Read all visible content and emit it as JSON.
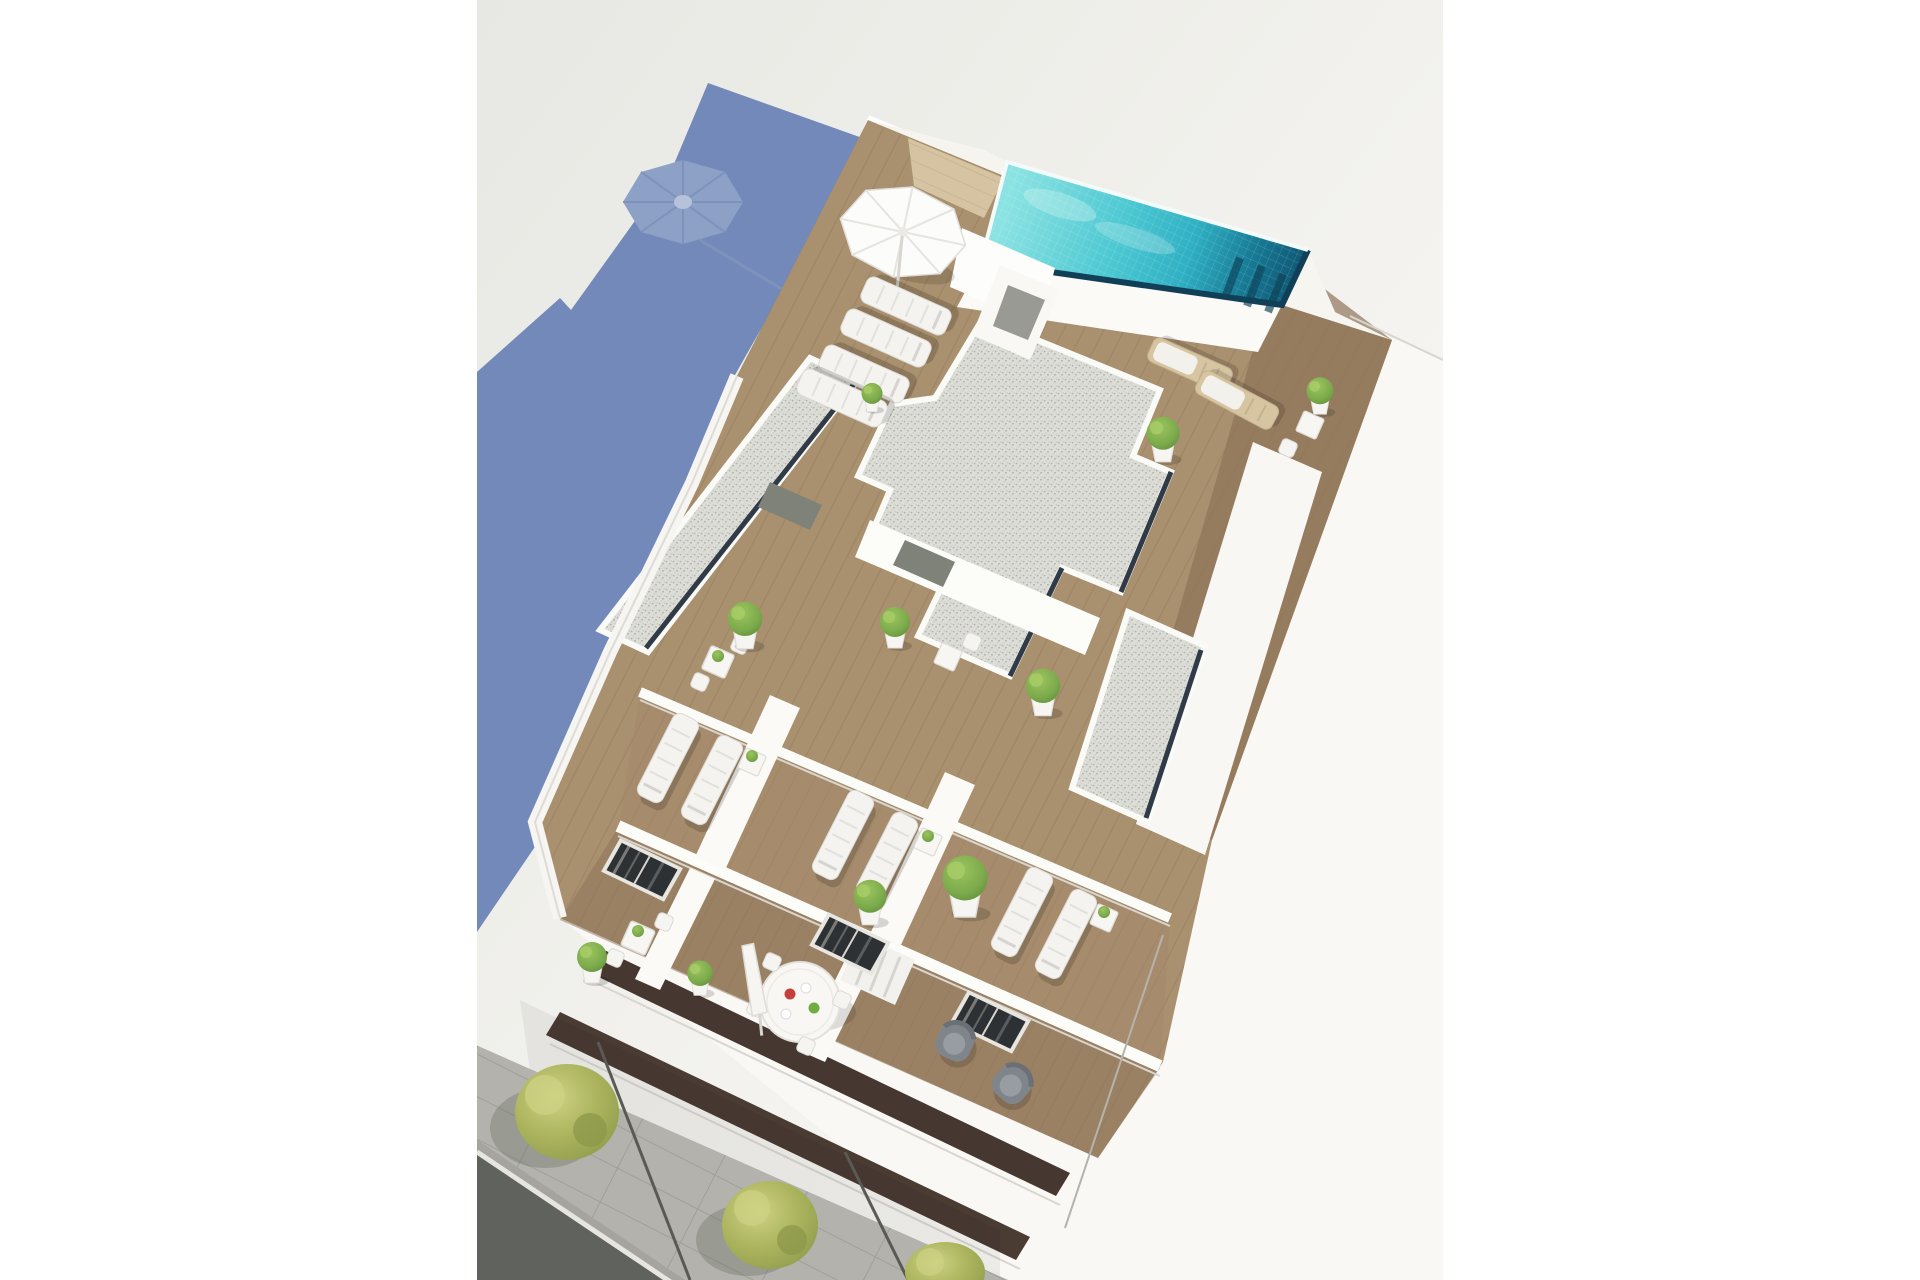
{
  "scene": {
    "type": "natural-image",
    "subject": "aerial-3d-architectural-render-of-apartment-building-rooftop-with-pool-terraces-and-street",
    "palette": {
      "page": "#ffffff",
      "backdrop_top": "#e7e8e3",
      "backdrop_mid": "#f3f2ee",
      "backdrop_bottom": "#fbfaf7",
      "shadow_blue": "#7389ba",
      "shadow_blue_light": "#8da0c6",
      "shadow_blue_lighter": "#b6c2da",
      "building_white": "#f9f8f5",
      "wall_white": "#fcfcf9",
      "wall_shade": "#dcdad5",
      "pool_light": "#8ae2e2",
      "pool_mid": "#2fb0c3",
      "pool_deep": "#177b96",
      "pool_dark": "#0f5572",
      "pool_rim": "#123f58",
      "wood_base": "#a9906e",
      "wood_pale": "#d6c3a1",
      "wood_dark": "#8d7158",
      "gravel": "#ddddd8",
      "gravel_dot": "#a8a8a1",
      "slot_navy": "#313b47",
      "facade_recess": "#463730",
      "glass_dark": "#2e3134",
      "curtain_gray": "#b9b7b2",
      "door_gray": "#7e8279",
      "lounger_white": "#f4f3ef",
      "wood_lounger": "#d7c5a2",
      "armchair_gray": "#80858c",
      "armchair_cushion": "#989da3",
      "plant_green": "#7cab4c",
      "plant_green_dark": "#5e8a38",
      "tree_yellow_green": "#aab25c",
      "tree_light": "#cdd283",
      "tree_dark": "#8d9a4b",
      "sidewalk": "#b3b2ad",
      "sidewalk_dark": "#a5a49f",
      "paver_line": "#9a9994",
      "asphalt": "#5f625d",
      "curb_white": "#e6e5e0",
      "corner_line": "#b5b3ae"
    },
    "elements": [
      "building-shadow",
      "parasol-shadow",
      "rooftop-pool",
      "roof-deck",
      "gravel-roofs",
      "roof-terraces",
      "balconies",
      "facade",
      "sidewalk",
      "street-asphalt",
      "street-trees",
      "sun-loungers",
      "parasols",
      "potted-plants",
      "outdoor-furniture"
    ]
  }
}
